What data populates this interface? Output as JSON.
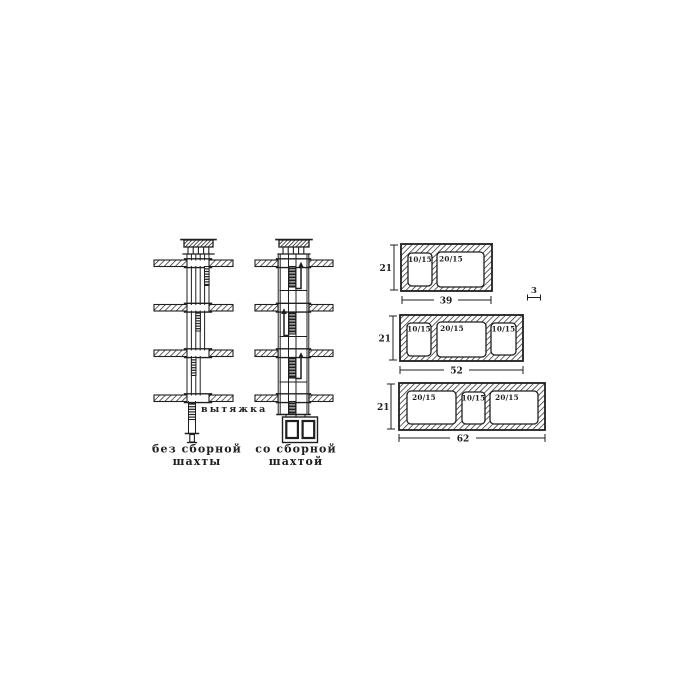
{
  "diagram": {
    "left": {
      "exhaust_label": "вытяжка",
      "caption_without": {
        "line1": "без сборной",
        "line2": "шахты"
      },
      "caption_with": {
        "line1": "со сборной",
        "line2": "шахтой"
      }
    },
    "blocks": [
      {
        "height": "21",
        "width": "39",
        "openings": [
          "10/15",
          "20/15"
        ]
      },
      {
        "height": "21",
        "width": "52",
        "openings": [
          "10/15",
          "20/15",
          "10/15"
        ]
      },
      {
        "height": "21",
        "width": "62",
        "openings": [
          "20/15",
          "10/15",
          "20/15"
        ]
      }
    ],
    "wall_thickness": "3",
    "colors": {
      "ink": "#1f1f1f",
      "background": "#ffffff"
    }
  }
}
